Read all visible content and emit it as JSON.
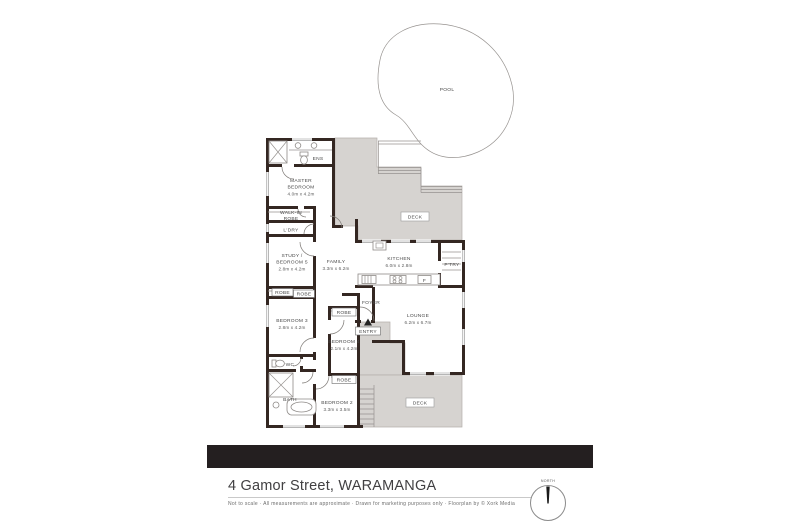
{
  "address": {
    "title": "4 Gamor Street, WARAMANGA"
  },
  "footer": {
    "disclaimer": "Not to scale  ·  All measurements are approximate  ·  Drawn for marketing purposes only  ·  Floorplan by © Xork Media"
  },
  "compass": {
    "label": "NORTH"
  },
  "plan": {
    "rooms": [
      {
        "name": "ENS"
      },
      {
        "name": "MASTER",
        "name2": "BEDROOM",
        "dims": "4.0m x 4.2m"
      },
      {
        "name": "WALK-IN",
        "name2": "ROBE"
      },
      {
        "name": "L'DRY"
      },
      {
        "name": "STUDY /",
        "name2": "BEDROOM 5",
        "dims": "2.8m x 4.2m"
      },
      {
        "name": "ROBE"
      },
      {
        "name": "ROBE"
      },
      {
        "name": "BEDROOM 3",
        "dims": "2.8m x 4.2m"
      },
      {
        "name": "WC"
      },
      {
        "name": "BATH"
      },
      {
        "name": "BEDROOM 2",
        "dims": "3.3m x 3.5m"
      },
      {
        "name": "ROBE"
      },
      {
        "name": "BEDROOM 4",
        "dims": "2.1m x 4.2m"
      },
      {
        "name": "ROBE"
      },
      {
        "name": "FAMILY",
        "dims": "3.3m x 6.2m"
      },
      {
        "name": "KITCHEN",
        "dims": "6.0m x 2.8m"
      },
      {
        "name": "P'TRY"
      },
      {
        "name": "FOYER"
      },
      {
        "name": "ENTRY"
      },
      {
        "name": "LOUNGE",
        "dims": "6.2m x 6.7m"
      }
    ],
    "areas": {
      "deck_top": "DECK",
      "deck_bottom": "DECK",
      "pool": "POOL"
    },
    "fixtures": {
      "fridge": "F"
    }
  }
}
